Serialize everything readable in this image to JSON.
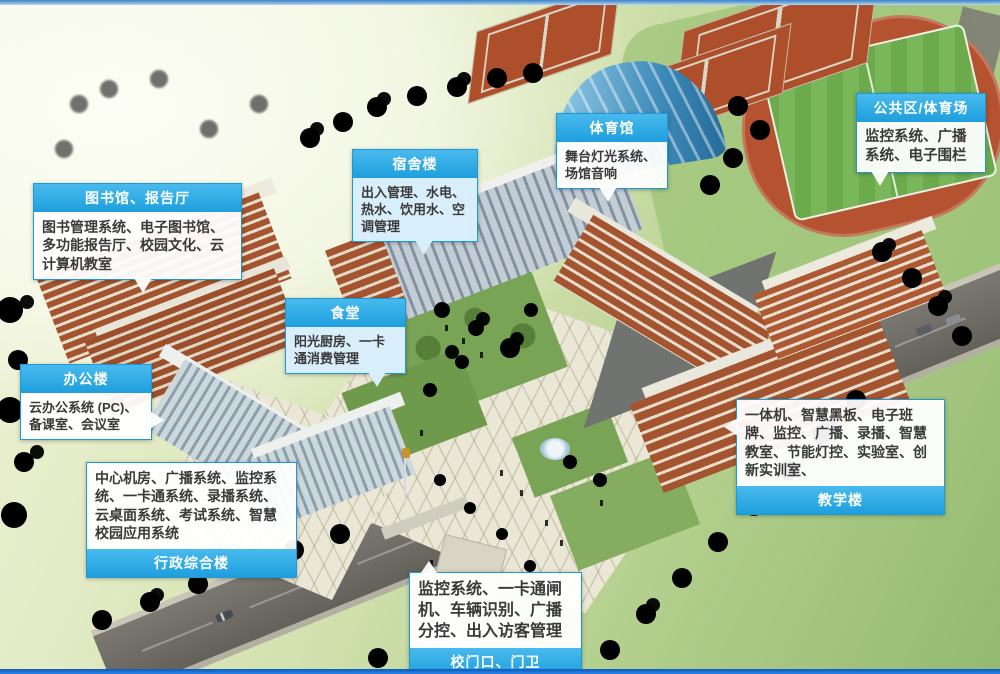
{
  "style": {
    "accent_blue": "#29a9e2",
    "top_bar_blue": "#5b9bd5",
    "bottom_bar_blue": "#1669c9",
    "track_red": "#b5522f",
    "field_green": "#6fae4e",
    "brick_red": "#a4542e"
  },
  "callouts": [
    {
      "id": "library",
      "title": "图书馆、报告厅",
      "body": "图书管理系统、电子图书馆、多功能报告厅、校园文化、云计算机教室"
    },
    {
      "id": "dorm",
      "title": "宿舍楼",
      "body": "出入管理、水电、热水、饮用水、空调管理"
    },
    {
      "id": "gym",
      "title": "体育馆",
      "body": "舞台灯光系统、场馆音响"
    },
    {
      "id": "public",
      "title": "公共区/体育场",
      "body": "监控系统、广播系统、电子围栏"
    },
    {
      "id": "canteen",
      "title": "食堂",
      "body": "阳光厨房、一卡通消费管理"
    },
    {
      "id": "office",
      "title": "办公楼",
      "body": "云办公系统 (PC)、备课室、会议室"
    },
    {
      "id": "admin",
      "title": "行政综合楼",
      "body": "中心机房、广播系统、监控系统、一卡通系统、录播系统、云桌面系统、考试系统、智慧校园应用系统"
    },
    {
      "id": "teaching",
      "title": "教学楼",
      "body": "一体机、智慧黑板、电子班牌、监控、广播、录播、智慧教室、节能灯控、实验室、创新实训室、"
    },
    {
      "id": "gate",
      "title": "校门口、门卫",
      "body": "监控系统、一卡通闸机、车辆识别、广播分控、出入访客管理"
    }
  ]
}
